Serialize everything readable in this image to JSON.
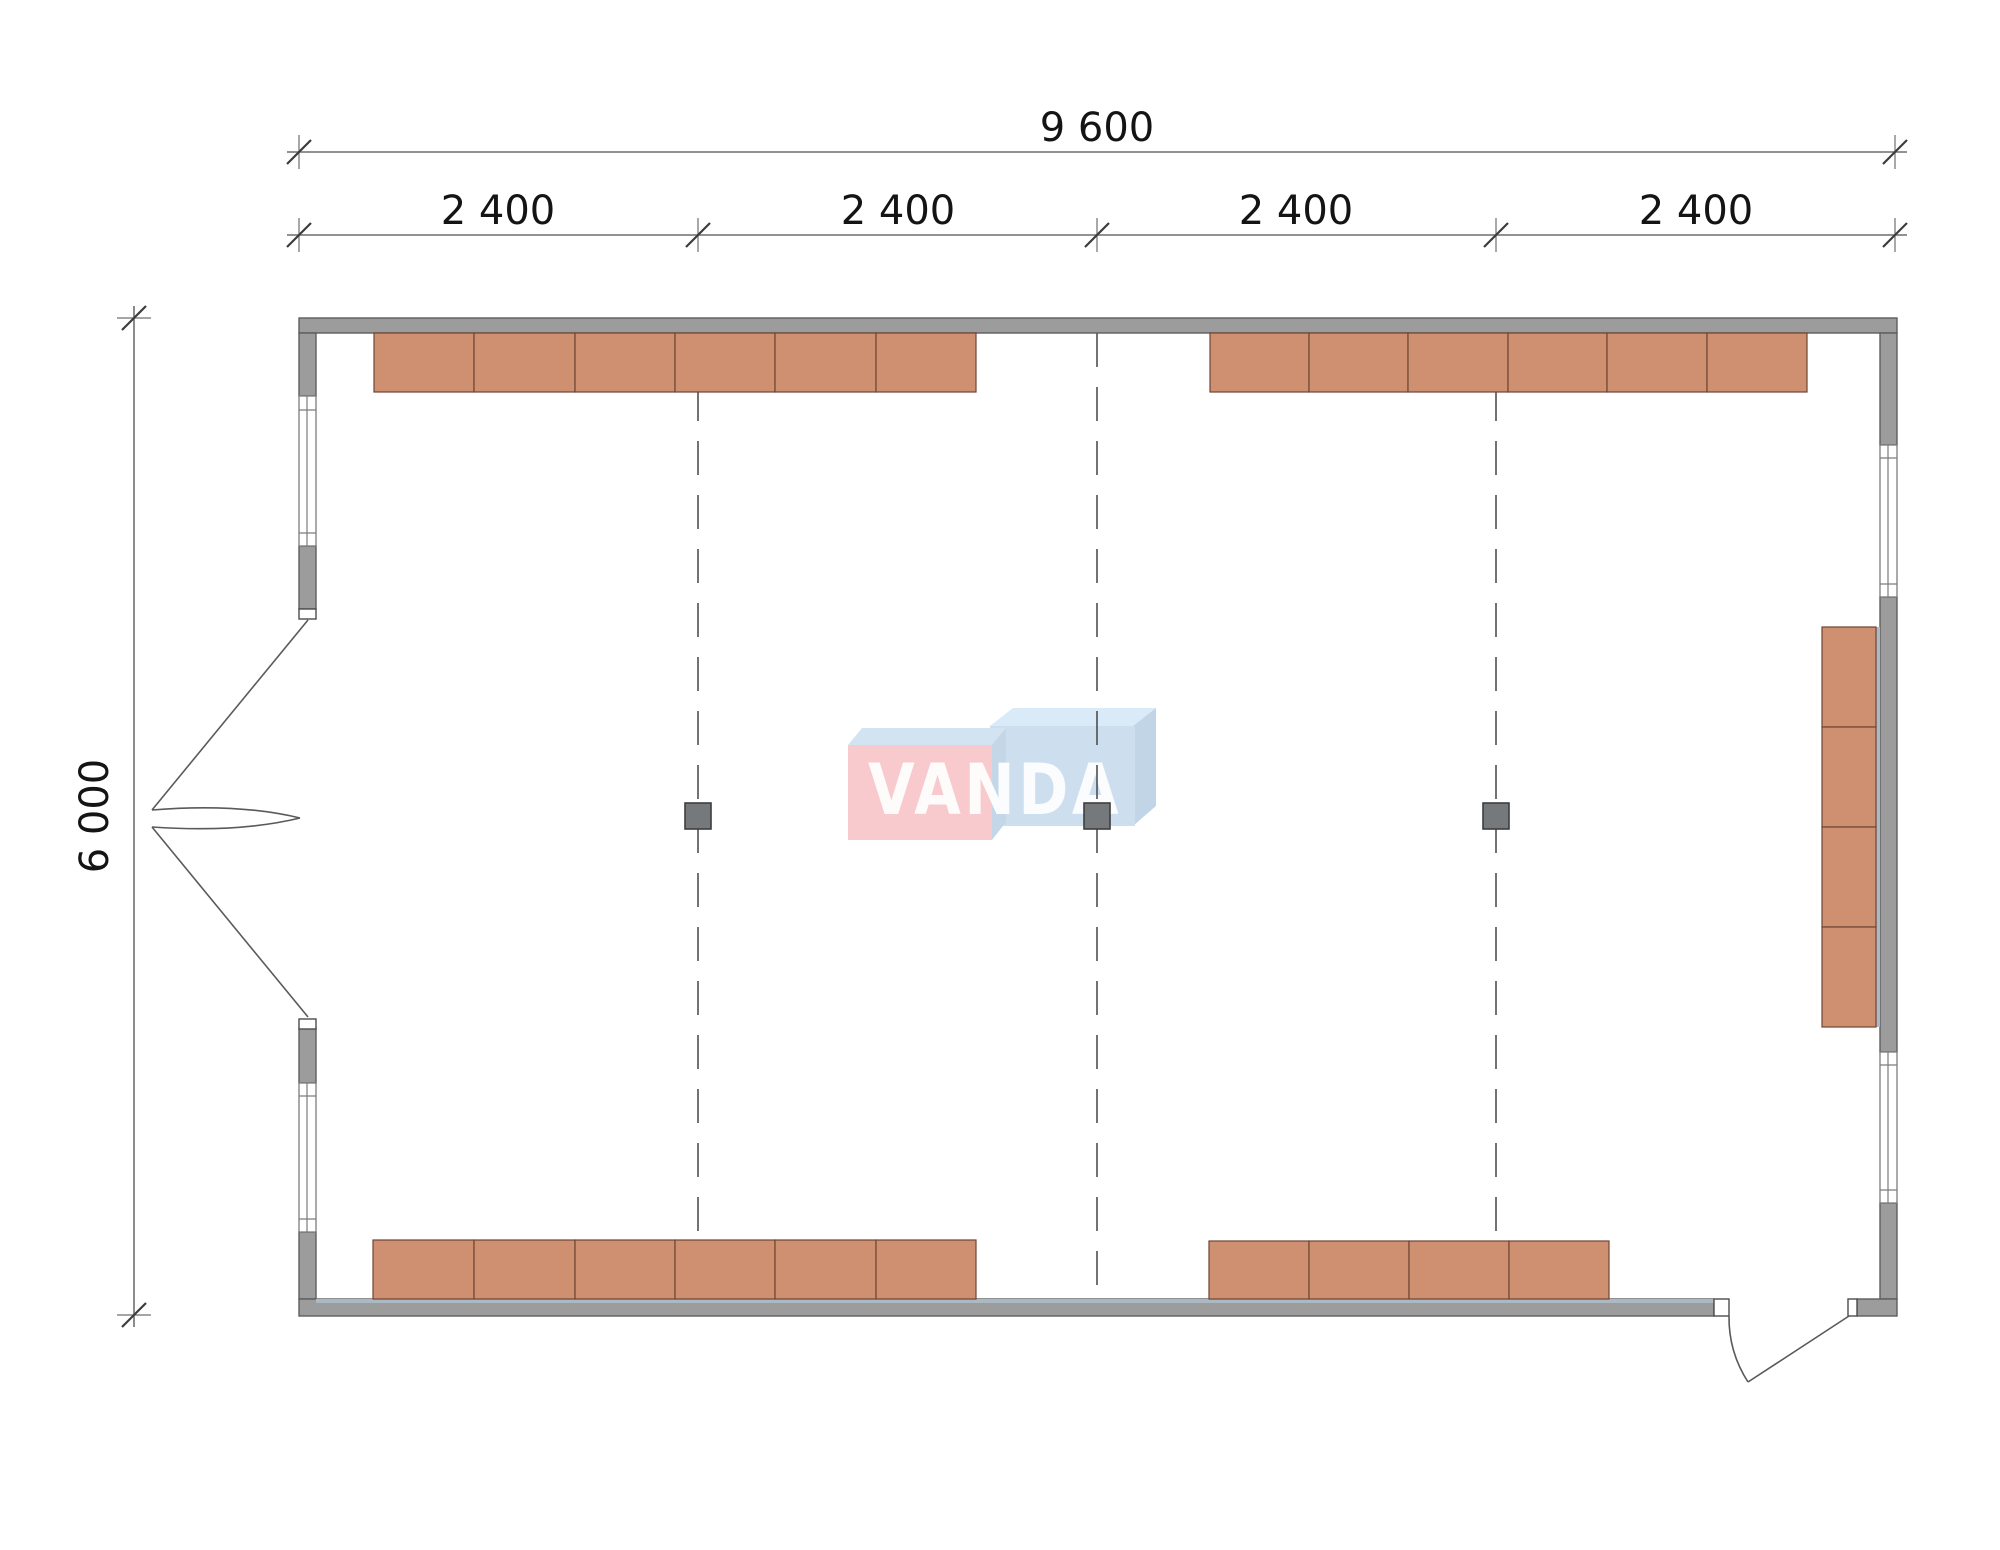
{
  "drawing": {
    "type": "architectural floor plan",
    "watermark_text": "VANDA"
  },
  "dimensions": {
    "overall_width_label": "9 600",
    "bay_labels": [
      "2 400",
      "2 400",
      "2 400",
      "2 400"
    ],
    "overall_height_label": "6 000"
  },
  "plan": {
    "grid_lines": 3,
    "structural_columns": 3,
    "desk_rows": {
      "top_left_blocks": 6,
      "top_right_blocks": 6,
      "bottom_left_blocks": 6,
      "bottom_right_blocks": 4,
      "right_wall_stack_blocks": 4
    },
    "windows_left": 2,
    "windows_right": 2,
    "doors": {
      "left_wall": "double leaf outward",
      "bottom_wall": "single leaf outward"
    }
  },
  "colors": {
    "wall-fill": "#9c9c9c",
    "wall-edge": "#5e5e5e",
    "stripe": "#aab9c3",
    "furniture-fill": "#cf9071",
    "furniture-edge": "#6f4433",
    "column-fill": "#75797c",
    "column-edge": "#3e3e3e",
    "grid-line": "#4f4f4f",
    "dim-line": "#6f6f6f",
    "dim-tick": "#3c3c3c",
    "dim-text": "#141414",
    "window-fill": "#ffffff",
    "window-edge": "#7c7c7c",
    "door-line": "#5a5a5a",
    "logo-pink": "#f8cace",
    "logo-pink-top": "#d2e4f2",
    "logo-pink-side": "#c3d7e8",
    "logo-blue": "#cddfee",
    "logo-blue-top": "#d9eaf8",
    "logo-blue-side": "#c2d5e7",
    "logo-text": "#ffffff"
  }
}
